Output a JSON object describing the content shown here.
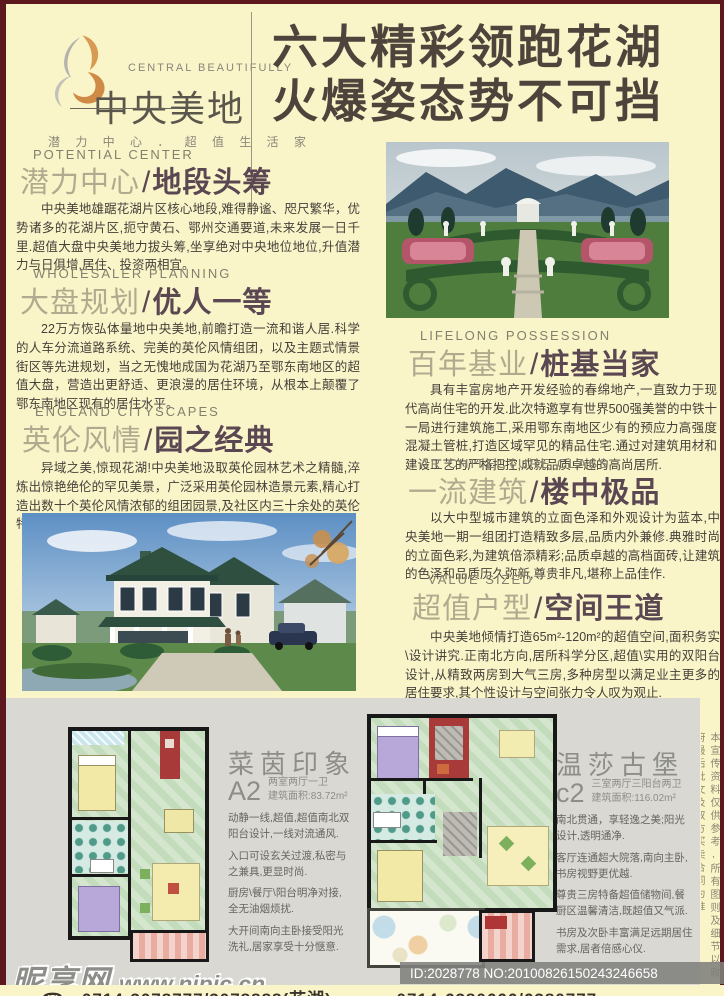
{
  "ui": {
    "slash": "/"
  },
  "colors": {
    "page_bg": "#faf5c9",
    "border_maroon": "#5c181c",
    "headline_text": "#4e443c",
    "heading_light": "#b2aa8e",
    "heading_bold": "#5a4752",
    "panel_gray": "#d9d8d3",
    "plan_red": "#a83a3a",
    "plan_green_stripe": "#c3dcbb"
  },
  "header": {
    "logo_en": "CENTRAL BEAUTIFULLY",
    "logo_cn": "中央美地",
    "logo_tagline": "潜 力 中 心 ． 超 值 生 活 家",
    "headline_line1": "六大精彩领跑花湖",
    "headline_line2": "火爆姿态势不可挡"
  },
  "sections": [
    {
      "label": "POTENTIAL CENTER",
      "cn_light": "潜力中心",
      "cn_bold": "地段头筹",
      "body": "中央美地雄踞花湖片区核心地段,难得静谧、咫尺繁华，优势诸多的花湖片区,扼守黄石、鄂州交通要道,未来发展一日千里.超值大盘中央美地力拔头筹,坐享绝对中央地位地位,升值潜力与日俱增,居住、投资两相宜。"
    },
    {
      "label": "WHOLESALER PLANNING",
      "cn_light": "大盘规划",
      "cn_bold": "优人一等",
      "body": "22万方恢弘体量地中央美地,前瞻打造一流和谐人居.科学的人车分流道路系统、完美的英伦风情组团，以及主题式情景街区等先进规划，当之无愧地成国为花湖乃至鄂东南地区的超值大盘，营造出更舒适、更浪漫的居住环境，从根本上颠覆了鄂东南地区现有的居住水平。"
    },
    {
      "label": "ENGLAND CITYSCAPES",
      "cn_light": "英伦风情",
      "cn_bold": "园之经典",
      "body": "异域之美,惊现花湖!中央美地汲取英伦园林艺术之精髓,淬炼出惊艳绝伦的罕见美景，广泛采用英伦园林造景元素,精心打造出数十个英伦风情浓郁的组团园景,及社区内三十余处的英伦特色景点,鼎力成就传世园林"
    },
    {
      "label": "LIFELONG POSSESSION",
      "cn_light": "百年基业",
      "cn_bold": "桩基当家",
      "body": "具有丰富房地产开发经验的春绵地产,一直致力于现代高尚住宅的开发.此次特邀享有世界500强美誉的中铁十一局进行建筑施工,采用鄂东南地区少有的预应力高强度混凝土管桩,打造区域罕见的精品住宅.通过对建筑用材和建设工艺的严格把控,成就品质卓越的高尚居所."
    },
    {
      "label": "AR CHITECTURE CLASS",
      "cn_light": "一流建筑",
      "cn_bold": "楼中极品",
      "body": "以大中型城市建筑的立面色泽和外观设计为蓝本,中央美地一期一组团打造精致多层,品质内外兼修.典雅时尚的立面色彩,为建筑倍添精彩;品质卓越的高档面砖,让建筑的色泽和品质历久弥新,尊贵非凡,堪称上品佳作."
    },
    {
      "label": "VALUE SIZED",
      "cn_light": "超值户型",
      "cn_bold": "空间王道",
      "body": "中央美地倾情打造65m²-120m²的超值空间,面积务实\\设计讲究.正南北方向,居所科学分区,超值\\实用的双阳台设计,从精致两房到大气三房,多种房型以满足业主更多的居住要求,其个性设计与空间张力令人叹为观止."
    }
  ],
  "floorplans": [
    {
      "title": "菜茵印象",
      "code": "A2",
      "spec": "两室两厅一卫",
      "area": "建筑面积:83.72m²",
      "desc": [
        "动静一线,超值,超值南北双阳台设计,一线对流通风.",
        "入口可设玄关过渡,私密与之兼具,更显时尚.",
        "厨房\\餐厅\\阳台明净对接,全无油烟烦扰.",
        "大开间南向主卧接受阳光洗礼,居家享受十分惬意."
      ]
    },
    {
      "title": "温莎古堡",
      "code": "c2",
      "spec": "三室两厅三阳台两卫",
      "area": "建筑面积:116.02m²",
      "desc": [
        "南北贯通，享轻逸之美;阳光设计,透明通净.",
        "客厅连通超大院落,南向主卧,书房视野更优越.",
        "尊贵三房特备超值储物间,餐厨区温馨清洁,既超值又气派.",
        "书房及次卧丰富满足远期居住需求,居者倍感心仪."
      ]
    }
  ],
  "footer": {
    "watermark_cn": "昵享网",
    "watermark_url": "www.nipic.cn",
    "id_text": "ID:2028778 NO:20100826150243246658",
    "phone_icon": "☎",
    "phone_left": "0714-3078777/3078888(花湖)",
    "phone_right": "0714-6380666/6380777",
    "disclaimer": "本宣传资料仅供参考,所有图则及细节以政府最后批文及双方买卖合同为准"
  }
}
